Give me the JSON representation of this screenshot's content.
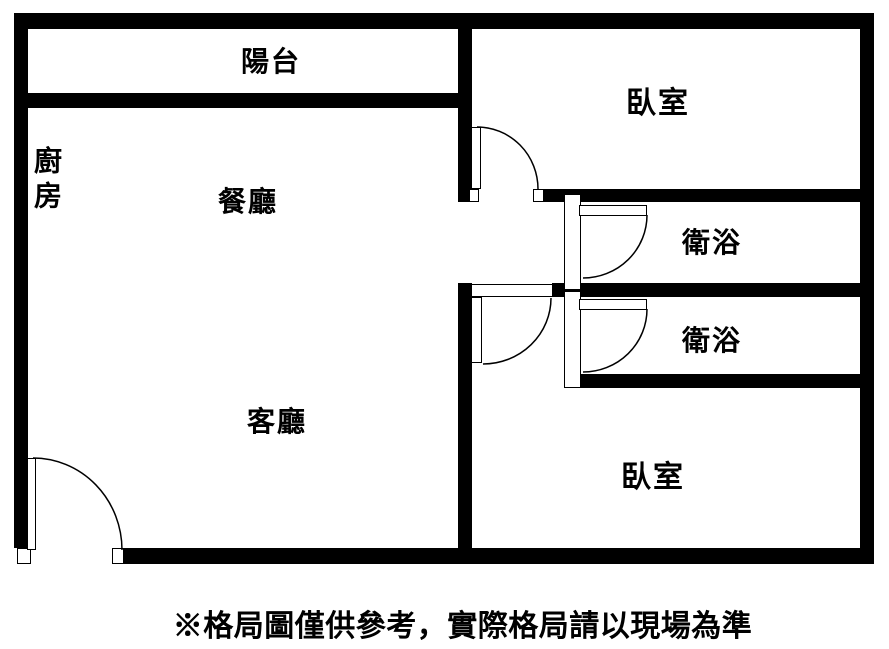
{
  "floorplan": {
    "rooms": {
      "balcony": {
        "label": "陽台"
      },
      "kitchen": {
        "label": "廚房"
      },
      "dining": {
        "label": "餐廳"
      },
      "living": {
        "label": "客廳"
      },
      "bedroom_top": {
        "label": "臥室"
      },
      "bedroom_bottom": {
        "label": "臥室"
      },
      "bath_upper": {
        "label": "衛浴"
      },
      "bath_lower": {
        "label": "衛浴"
      }
    },
    "caption": "※格局圖僅供參考，實際格局請以現場為準",
    "colors": {
      "wall": "#000000",
      "background": "#ffffff",
      "text": "#000000"
    }
  }
}
